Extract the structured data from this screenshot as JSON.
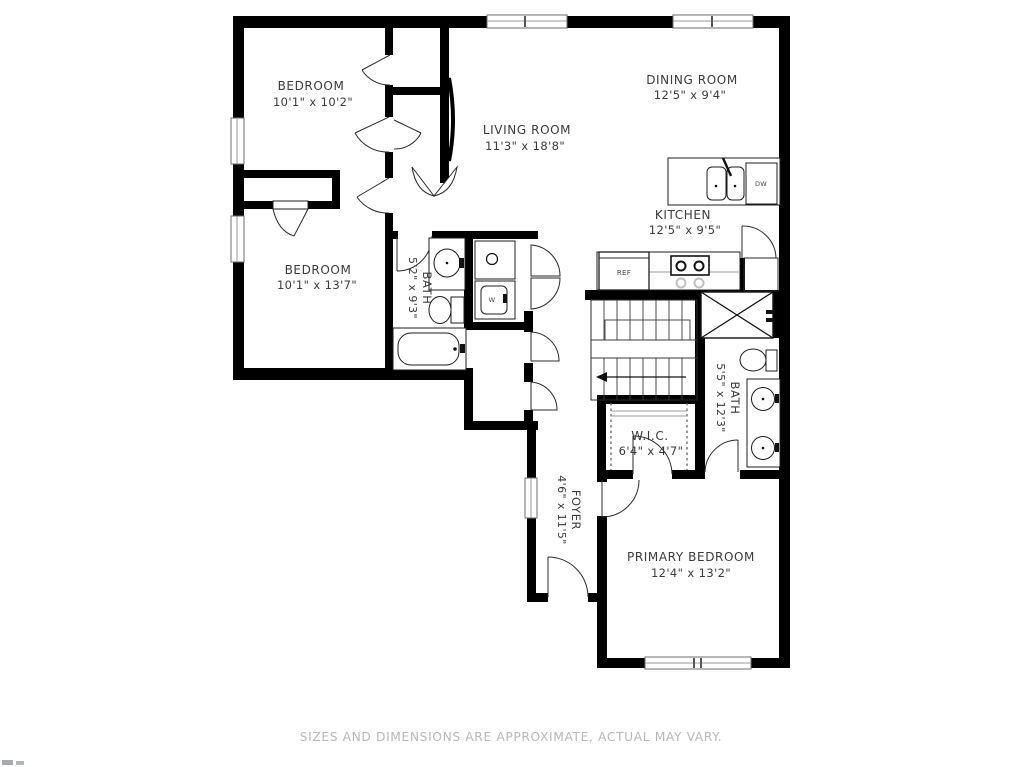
{
  "rooms": [
    {
      "id": "bedroom-top",
      "name": "BEDROOM",
      "dims": "10'1\" x 10'2\""
    },
    {
      "id": "dining-room",
      "name": "DINING ROOM",
      "dims": "12'5\" x 9'4\""
    },
    {
      "id": "living-room",
      "name": "LIVING ROOM",
      "dims": "11'3\" x 18'8\""
    },
    {
      "id": "kitchen",
      "name": "KITCHEN",
      "dims": "12'5\" x 9'5\""
    },
    {
      "id": "bedroom-middle",
      "name": "BEDROOM",
      "dims": "10'1\" x 13'7\""
    },
    {
      "id": "bath-small",
      "name": "BATH",
      "dims": "5'2\" x 9'3\""
    },
    {
      "id": "bath-primary",
      "name": "BATH",
      "dims": "5'5\" x 12'3\""
    },
    {
      "id": "walk-in-closet",
      "name": "W.I.C.",
      "dims": "6'4\" x 4'7\""
    },
    {
      "id": "foyer",
      "name": "FOYER",
      "dims": "4'6\" x 11'5\""
    },
    {
      "id": "primary-bedroom",
      "name": "PRIMARY BEDROOM",
      "dims": "12'4\" x 13'2\""
    }
  ],
  "appliances": {
    "refrigerator": "REF",
    "dishwasher": "DW",
    "washer": "W"
  },
  "footer": {
    "disclaimer": "SIZES AND DIMENSIONS ARE APPROXIMATE, ACTUAL MAY VARY."
  },
  "colors": {
    "wall": "#000000",
    "label": "#3a3a3a",
    "window": "#9a9a9a",
    "disclaimer": "#b5b7b9",
    "background": "#ffffff"
  }
}
